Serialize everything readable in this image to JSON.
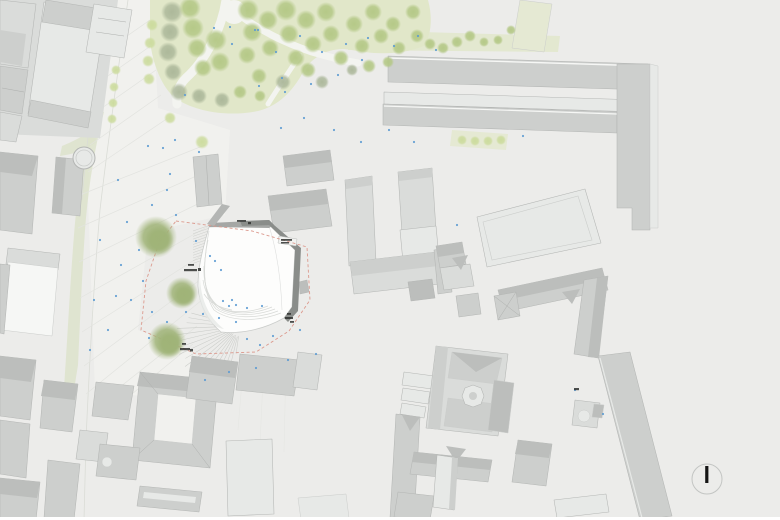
{
  "scene": {
    "type": "architectural site plan with proposed building, plaza, park and north arrow"
  },
  "north_arrow": {
    "glyph": "I"
  },
  "colors": {
    "bg": "#ececea",
    "plaza": "#f1f1ee",
    "lawn": "#e1e7c9",
    "lawn2": "#e5e9d3",
    "street": "#dde3cb",
    "path": "#f3f4f0",
    "curb": "#dadcd6",
    "paving": "#e2e3df",
    "hatch": "#c8cac6",
    "edge": "#b4b6b4",
    "edgeSoft": "#cbcdcb",
    "ridge": "#adafad",
    "bldgWhite": "#f6f7f5",
    "bldgXLight": "#e7e9e7",
    "bldgLight": "#dadcda",
    "bldgMid": "#cdcfcd",
    "bldgDark": "#bcbebc",
    "white1": "#fdfdfc",
    "contour": "#d8dad7",
    "roofBand": "#a5a7a5",
    "roofBandDark": "#8a8d8a",
    "boundary": "#dc9a8e",
    "people": "#5b9ad2",
    "labelDark": "#2f312f",
    "northNeedle": "#151515",
    "northRing": "#c3c5c3",
    "treeGreen": "#b4c886",
    "treeGray": "#aab698",
    "treePale": "#cbdb9b",
    "treeOlive": "#9fb377"
  },
  "map": {
    "fountain": {
      "x": 84,
      "y": 158,
      "r": 11
    },
    "trees_park_green": [
      [
        190,
        8,
        11
      ],
      [
        193,
        28,
        11
      ],
      [
        197,
        48,
        10
      ],
      [
        203,
        68,
        9
      ],
      [
        216,
        40,
        11
      ],
      [
        220,
        62,
        10
      ],
      [
        248,
        10,
        11
      ],
      [
        252,
        32,
        10
      ],
      [
        247,
        55,
        9
      ],
      [
        259,
        76,
        8
      ],
      [
        270,
        48,
        9
      ],
      [
        268,
        20,
        10
      ],
      [
        286,
        10,
        11
      ],
      [
        289,
        34,
        10
      ],
      [
        296,
        58,
        9
      ],
      [
        306,
        20,
        10
      ],
      [
        313,
        44,
        9
      ],
      [
        308,
        70,
        8
      ],
      [
        326,
        12,
        10
      ],
      [
        331,
        34,
        9
      ],
      [
        341,
        58,
        8
      ],
      [
        354,
        24,
        9
      ],
      [
        362,
        46,
        8
      ],
      [
        373,
        12,
        9
      ],
      [
        381,
        36,
        8
      ],
      [
        369,
        66,
        7
      ],
      [
        393,
        24,
        8
      ],
      [
        399,
        48,
        7
      ],
      [
        413,
        12,
        8
      ],
      [
        417,
        36,
        7
      ],
      [
        430,
        44,
        6
      ],
      [
        443,
        48,
        6
      ],
      [
        457,
        42,
        6
      ],
      [
        470,
        36,
        6
      ],
      [
        484,
        42,
        5
      ],
      [
        498,
        40,
        5
      ],
      [
        511,
        30,
        5
      ],
      [
        388,
        62,
        6
      ],
      [
        240,
        92,
        7
      ],
      [
        260,
        96,
        6
      ]
    ],
    "trees_park_gray": [
      [
        172,
        12,
        11
      ],
      [
        170,
        32,
        10
      ],
      [
        168,
        52,
        10
      ],
      [
        173,
        72,
        9
      ],
      [
        179,
        92,
        9
      ],
      [
        199,
        96,
        8
      ],
      [
        222,
        100,
        8
      ],
      [
        283,
        82,
        8
      ],
      [
        322,
        82,
        7
      ],
      [
        352,
        70,
        6
      ]
    ],
    "trees_street": [
      [
        152,
        25,
        6
      ],
      [
        150,
        43,
        6
      ],
      [
        148,
        61,
        6
      ],
      [
        149,
        79,
        6
      ],
      [
        116,
        70,
        5
      ],
      [
        114,
        87,
        5
      ],
      [
        113,
        103,
        5
      ],
      [
        112,
        119,
        5
      ],
      [
        202,
        142,
        7
      ],
      [
        170,
        118,
        6
      ]
    ],
    "trees_row_east": [
      [
        462,
        140,
        5
      ],
      [
        475,
        141,
        5
      ],
      [
        488,
        141,
        5
      ],
      [
        501,
        140,
        5
      ]
    ],
    "trees_large": [
      [
        156,
        237,
        21
      ],
      [
        182,
        293,
        16
      ],
      [
        167,
        341,
        19
      ]
    ],
    "people_dots": [
      [
        148,
        146
      ],
      [
        163,
        148
      ],
      [
        170,
        174
      ],
      [
        167,
        190
      ],
      [
        152,
        205
      ],
      [
        176,
        215
      ],
      [
        127,
        222
      ],
      [
        139,
        250
      ],
      [
        121,
        265
      ],
      [
        143,
        281
      ],
      [
        131,
        300
      ],
      [
        152,
        312
      ],
      [
        167,
        322
      ],
      [
        149,
        338
      ],
      [
        186,
        312
      ],
      [
        203,
        314
      ],
      [
        219,
        318
      ],
      [
        236,
        322
      ],
      [
        210,
        256
      ],
      [
        221,
        270
      ],
      [
        196,
        241
      ],
      [
        232,
        300
      ],
      [
        247,
        339
      ],
      [
        260,
        345
      ],
      [
        273,
        336
      ],
      [
        300,
        330
      ],
      [
        316,
        354
      ],
      [
        288,
        360
      ],
      [
        256,
        368
      ],
      [
        229,
        372
      ],
      [
        205,
        380
      ],
      [
        214,
        28
      ],
      [
        232,
        44
      ],
      [
        258,
        30
      ],
      [
        276,
        52
      ],
      [
        300,
        36
      ],
      [
        322,
        52
      ],
      [
        346,
        44
      ],
      [
        368,
        38
      ],
      [
        394,
        46
      ],
      [
        418,
        36
      ],
      [
        259,
        86
      ],
      [
        285,
        92
      ],
      [
        311,
        84
      ],
      [
        338,
        75
      ],
      [
        362,
        60
      ],
      [
        436,
        50
      ],
      [
        304,
        118
      ],
      [
        281,
        128
      ],
      [
        334,
        130
      ],
      [
        361,
        142
      ],
      [
        389,
        130
      ],
      [
        414,
        142
      ],
      [
        457,
        225
      ],
      [
        523,
        136
      ],
      [
        575,
        390
      ],
      [
        603,
        414
      ],
      [
        199,
        152
      ],
      [
        175,
        140
      ],
      [
        118,
        180
      ],
      [
        100,
        240
      ],
      [
        94,
        300
      ],
      [
        90,
        350
      ],
      [
        108,
        330
      ],
      [
        116,
        296
      ],
      [
        223,
        301
      ],
      [
        229,
        306
      ],
      [
        236,
        305
      ],
      [
        247,
        308
      ],
      [
        262,
        306
      ],
      [
        215,
        261
      ],
      [
        185,
        95
      ],
      [
        230,
        27
      ],
      [
        255,
        30
      ],
      [
        282,
        78
      ]
    ],
    "micro_label_marks": [
      [
        237,
        220,
        9,
        1.8
      ],
      [
        248,
        222,
        3,
        2.2
      ],
      [
        281,
        239,
        11,
        1.8
      ],
      [
        281,
        242,
        8,
        1.5
      ],
      [
        188,
        264,
        6,
        1.8
      ],
      [
        184,
        269,
        13,
        2.2
      ],
      [
        198,
        268,
        3,
        3
      ],
      [
        287,
        313,
        4,
        1.8
      ],
      [
        285,
        317,
        8,
        2
      ],
      [
        290,
        321,
        4,
        1.8
      ],
      [
        182,
        343,
        4,
        1.8
      ],
      [
        180,
        348,
        10,
        2.2
      ],
      [
        190,
        349,
        3,
        2.5
      ],
      [
        574,
        388,
        5,
        2.2
      ]
    ]
  }
}
